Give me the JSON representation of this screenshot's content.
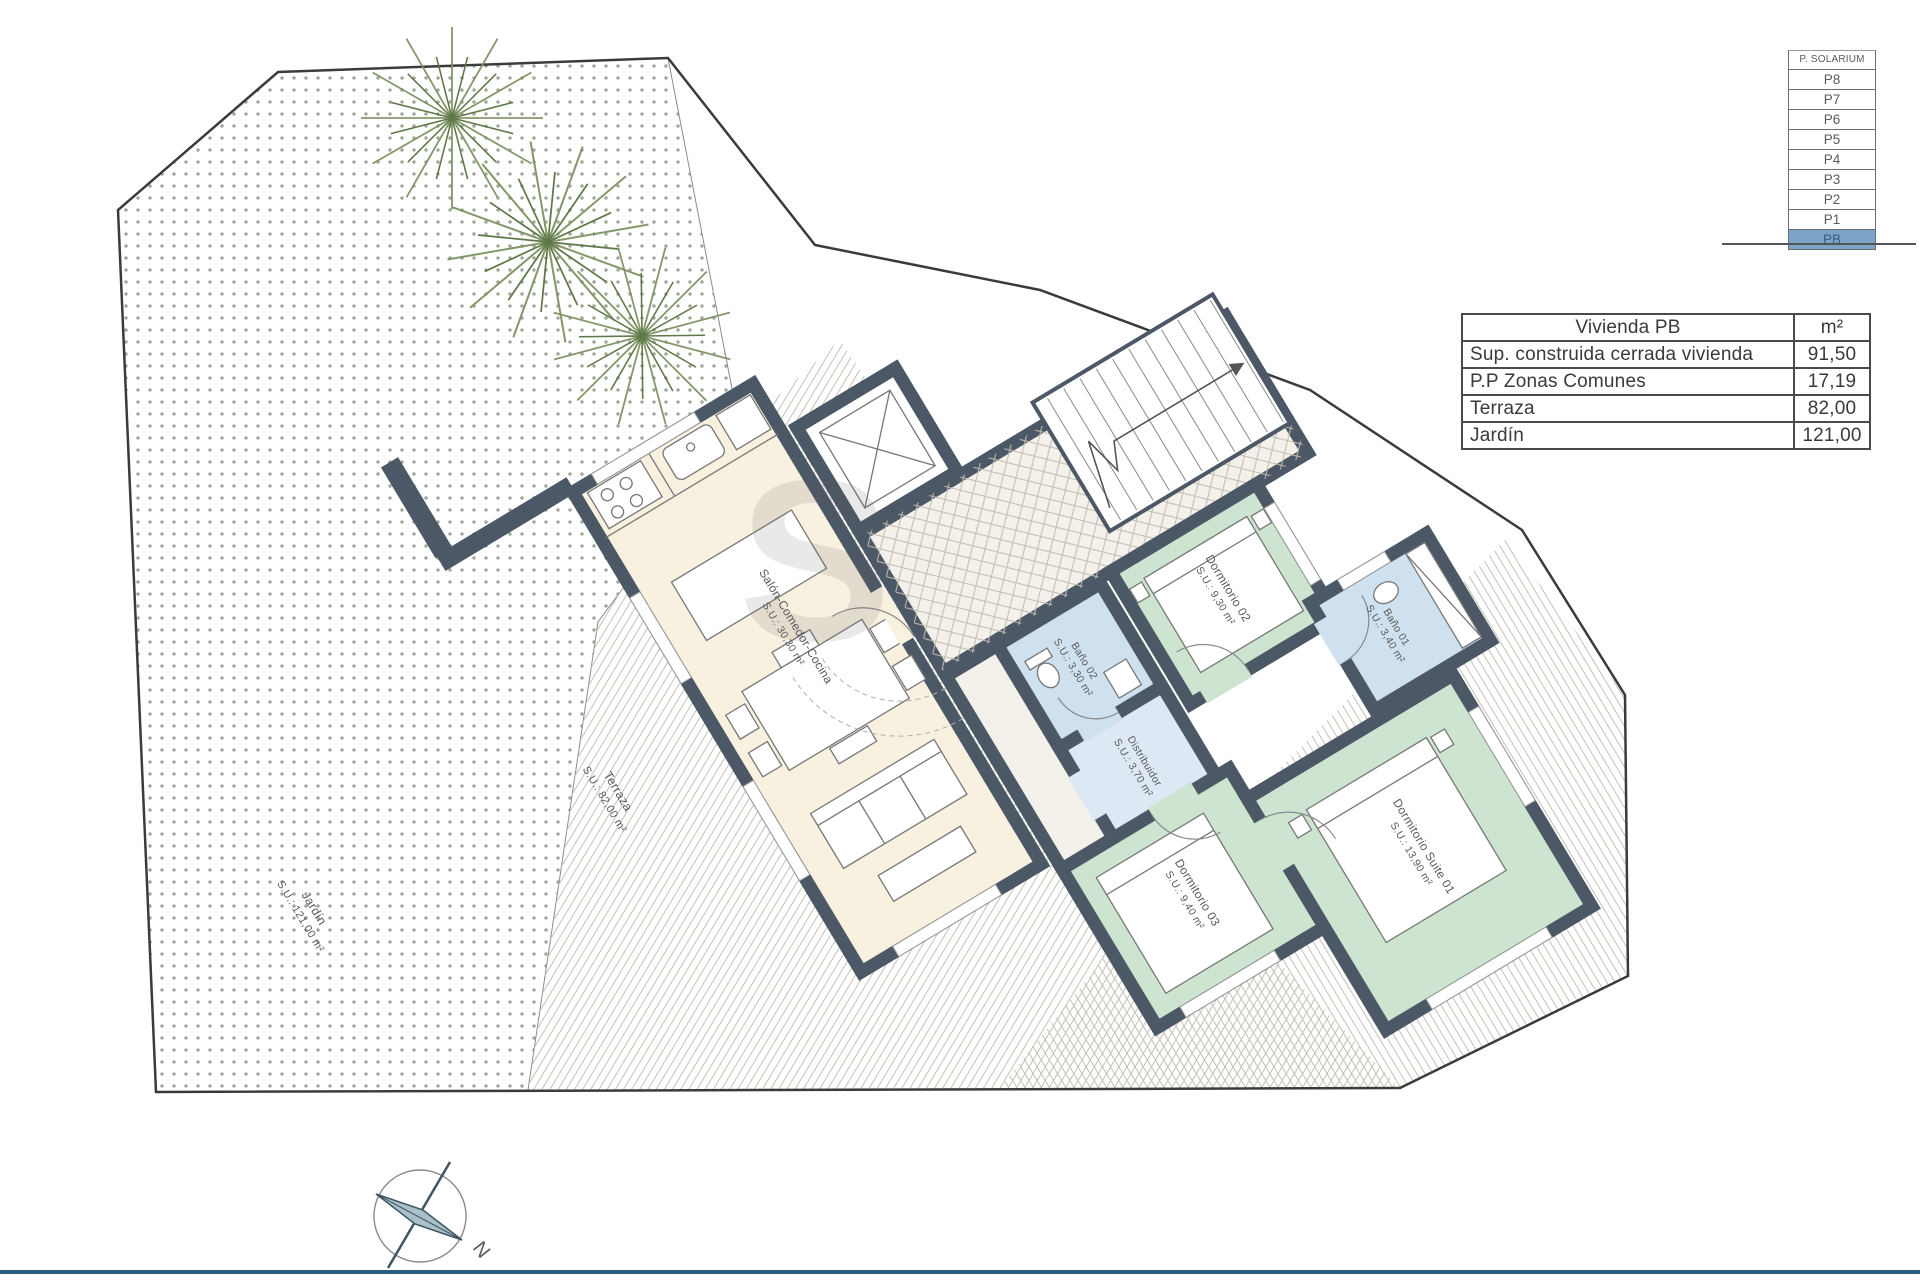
{
  "floor_selector": {
    "header": "P. SOLARIUM",
    "floors": [
      "P8",
      "P7",
      "P6",
      "P5",
      "P4",
      "P3",
      "P2",
      "P1",
      "PB"
    ],
    "active_floor": "PB"
  },
  "area_table": {
    "title": "Vivienda PB",
    "unit": "m²",
    "rows": [
      {
        "label": "Sup. construida cerrada vivienda",
        "value": "91,50"
      },
      {
        "label": "P.P Zonas Comunes",
        "value": "17,19"
      },
      {
        "label": "Terraza",
        "value": "82,00"
      },
      {
        "label": "Jardín",
        "value": "121,00"
      }
    ]
  },
  "rooms": [
    {
      "name": "Salón-Comedor-Cocina",
      "area": "S.U.: 30,30 m²"
    },
    {
      "name": "Dormitorio 02",
      "area": "S.U.: 9,30 m²"
    },
    {
      "name": "Baño 02",
      "area": "S.U.: 3,30 m²"
    },
    {
      "name": "Distribuidor",
      "area": "S.U.: 3,70 m²"
    },
    {
      "name": "Baño 01",
      "area": "S.U.: 3,40 m²"
    },
    {
      "name": "Dormitorio 03",
      "area": "S.U.: 9,40 m²"
    },
    {
      "name": "Dormitorio Suite 01",
      "area": "S.U.: 13,90 m²"
    }
  ],
  "site_labels": {
    "terraza": {
      "name": "Terraza",
      "area": "S.U.: 82,00 m²"
    },
    "jardin": {
      "name": "Jardín",
      "area": "S.U.: 121,00 m²"
    }
  },
  "compass": {
    "north": "N"
  },
  "watermark": "S",
  "colors": {
    "wall": "#4d5866",
    "living": "#f8f1e0",
    "bedroom": "#cde5d0",
    "bath": "#cfe0ee",
    "hall": "#dce8f3",
    "active_floor_bg": "#7ca3c8",
    "footer_line": "#2b5d7f"
  }
}
